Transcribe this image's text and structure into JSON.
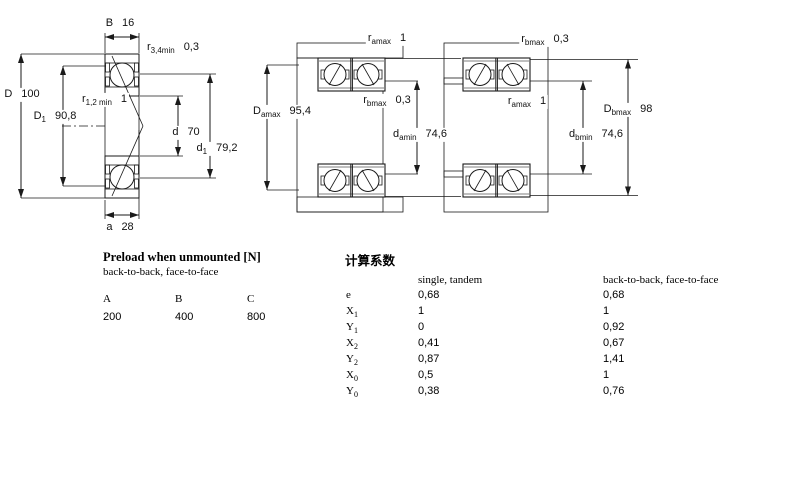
{
  "colors": {
    "ring_blue": "#c9daee",
    "steel_gray": "#d2d4d2",
    "line": "#1a1a1a",
    "background": "#ffffff"
  },
  "diagrams": {
    "left": {
      "dims": {
        "B": {
          "base": "B",
          "sub": "",
          "value": "16"
        },
        "r34": {
          "base": "r",
          "sub": "3,4min",
          "value": "0,3"
        },
        "r12": {
          "base": "r",
          "sub": "1,2 min",
          "value": "1"
        },
        "D": {
          "base": "D",
          "sub": "",
          "value": "100"
        },
        "D1": {
          "base": "D",
          "sub": "1",
          "value": "90,8"
        },
        "d": {
          "base": "d",
          "sub": "",
          "value": "70"
        },
        "d1": {
          "base": "d",
          "sub": "1",
          "value": "79,2"
        },
        "a": {
          "base": "a",
          "sub": "",
          "value": "28"
        }
      }
    },
    "middle": {
      "dims": {
        "ramax": {
          "base": "r",
          "sub": "amax",
          "value": "1"
        },
        "rbmax": {
          "base": "r",
          "sub": "bmax",
          "value": "0,3"
        },
        "Damax": {
          "base": "D",
          "sub": "amax",
          "value": "95,4"
        },
        "damin": {
          "base": "d",
          "sub": "amin",
          "value": "74,6"
        }
      }
    },
    "right": {
      "dims": {
        "rbmax": {
          "base": "r",
          "sub": "bmax",
          "value": "0,3"
        },
        "ramax": {
          "base": "r",
          "sub": "amax",
          "value": "1"
        },
        "Dbmax": {
          "base": "D",
          "sub": "bmax",
          "value": "98"
        },
        "dbmin": {
          "base": "d",
          "sub": "bmin",
          "value": "74,6"
        }
      }
    }
  },
  "preload": {
    "title": "Preload when unmounted [N]",
    "subtitle": "back-to-back, face-to-face",
    "columns": [
      "A",
      "B",
      "C"
    ],
    "values": [
      "200",
      "400",
      "800"
    ]
  },
  "factors": {
    "title": "计算系数",
    "col1_header": "single, tandem",
    "col2_header": "back-to-back, face-to-face",
    "rows": [
      {
        "base": "e",
        "sub": "",
        "single": "0,68",
        "paired": "0,68"
      },
      {
        "base": "X",
        "sub": "1",
        "single": "1",
        "paired": "1"
      },
      {
        "base": "Y",
        "sub": "1",
        "single": "0",
        "paired": "0,92"
      },
      {
        "base": "X",
        "sub": "2",
        "single": "0,41",
        "paired": "0,67"
      },
      {
        "base": "Y",
        "sub": "2",
        "single": "0,87",
        "paired": "1,41"
      },
      {
        "base": "X",
        "sub": "0",
        "single": "0,5",
        "paired": "1"
      },
      {
        "base": "Y",
        "sub": "0",
        "single": "0,38",
        "paired": "0,76"
      }
    ]
  }
}
